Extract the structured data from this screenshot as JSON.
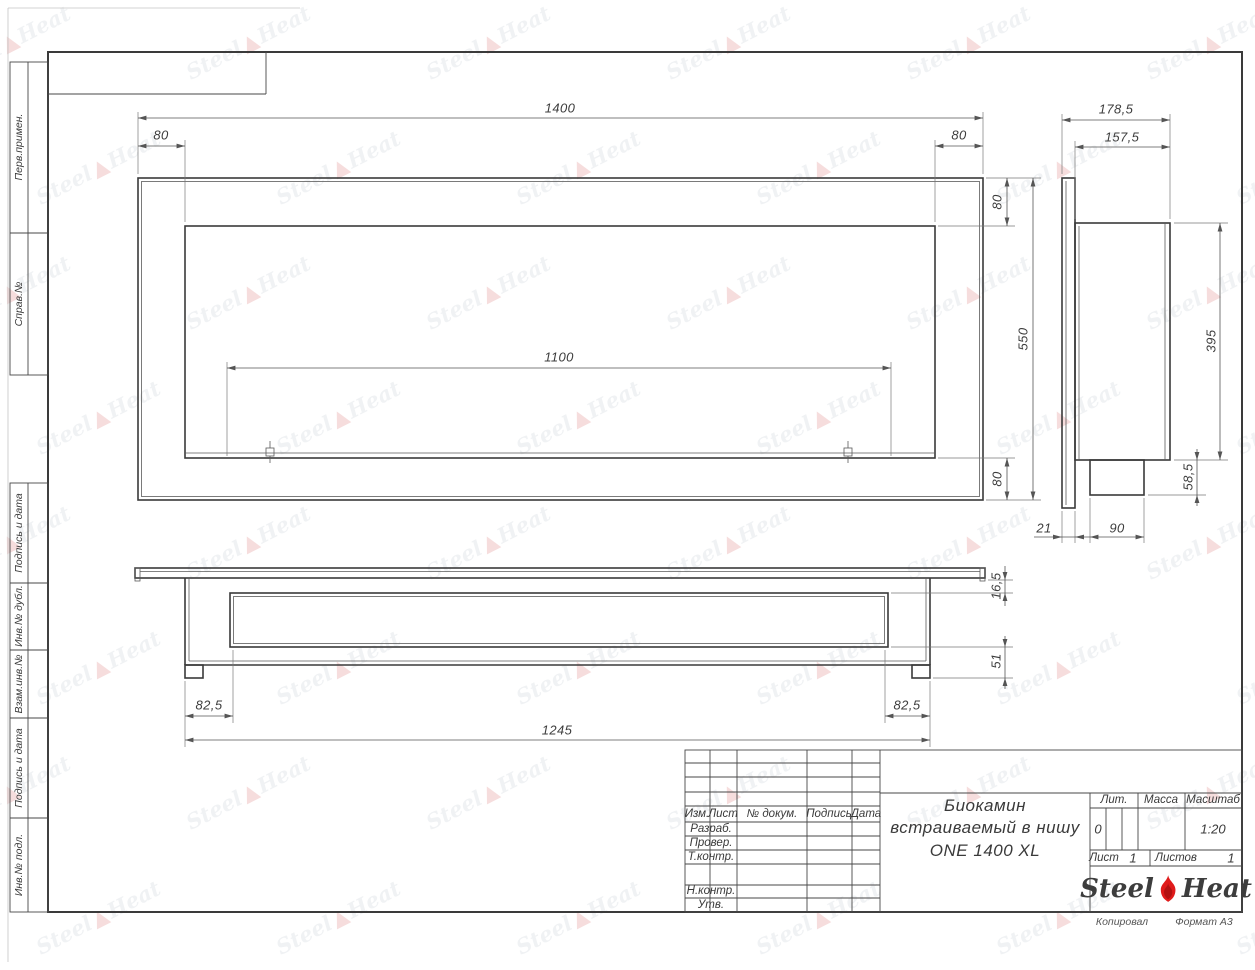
{
  "sheet": {
    "stamp_labels": [
      "Перв.примен.",
      "Справ.№",
      "Подпись и дата",
      "Инв.№ дубл.",
      "Взам.инв.№",
      "Подпись и дата",
      "Инв.№ подл."
    ],
    "footer": {
      "copied": "Копировал",
      "format": "Формат А3"
    }
  },
  "title_block": {
    "header_cols": [
      "Изм.",
      "Лист",
      "№ докум.",
      "Подпись",
      "Дата"
    ],
    "staff_rows": [
      "Разраб.",
      "Провер.",
      "Т.контр.",
      "Н.контр.",
      "Утв."
    ],
    "doc_title": {
      "line1": "Биокамин",
      "line2": "встраиваемый в нишу",
      "line3": "ONE 1400 XL"
    },
    "lit": {
      "label": "Лит.",
      "value": "0"
    },
    "mass": {
      "label": "Масса",
      "value": ""
    },
    "scale": {
      "label": "Масштаб",
      "value": "1:20"
    },
    "sheet_no": {
      "label": "Лист",
      "value": "1"
    },
    "sheets_total": {
      "label": "Листов",
      "value": "1"
    },
    "brand": {
      "steel": "Steel",
      "heat": "Heat"
    }
  },
  "dimensions": {
    "front": {
      "total_width": "1400",
      "top_left": "80",
      "top_right": "80",
      "opening_width": "1100",
      "right_top": "80",
      "total_height": "550",
      "right_bottom": "80"
    },
    "side": {
      "total_depth": "178,5",
      "body_depth": "157,5",
      "body_height": "395",
      "tray_height": "58,5",
      "flange_thickness": "21",
      "tray_depth": "90"
    },
    "bottom": {
      "left_inset": "82,5",
      "right_inset": "82,5",
      "body_width": "1245",
      "flange_offset": "16,5",
      "tray_drop": "51"
    }
  },
  "watermark": {
    "steel": "Steel",
    "heat": "Heat"
  },
  "colors": {
    "line": "#3a3a3a",
    "dim": "#555555",
    "flame_red": "#e01b1b"
  }
}
